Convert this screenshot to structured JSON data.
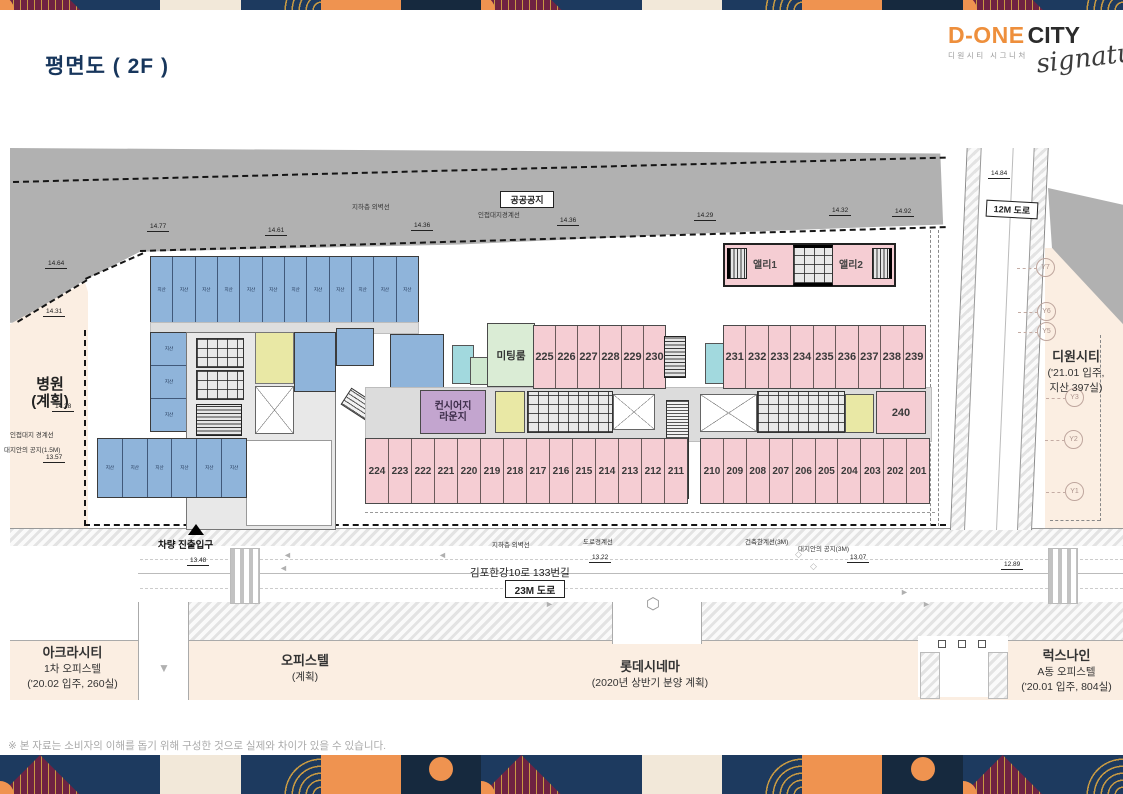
{
  "title": "평면도 ( 2F )",
  "logo": {
    "brand_orange": "D-ONE",
    "brand_dark": "CITY",
    "brand_sub": "디원시티 시그니처",
    "script": "signature"
  },
  "footnote": "※ 본 자료는 소비자의 이해를 돕기 위해 구성한 것으로 실제와 차이가 있을 수 있습니다.",
  "plan": {
    "labels": {
      "public_space": "공공공지",
      "underground_wall": "지하층 외벽선",
      "adjacent_boundary": "인접대지경계선",
      "road_12m": "12M 도로",
      "hospital": "병원",
      "hospital_sub": "(계획)",
      "adjacent_boundary_left": "인접대지 경계선",
      "site_setback_left": "대지안의 공지(1.5M)",
      "vehicle_entrance": "차량 진출입구",
      "underground_wall_bottom": "지하층 외벽선",
      "road_boundary": "도로경계선",
      "building_limit": "건축한계선(3M)",
      "site_setback_right": "대지안의 공지(3M)",
      "road_name": "김포한강10로 133번길",
      "road_23m": "23M 도로"
    },
    "dims": [
      "14.77",
      "14.61",
      "14.36",
      "14.36",
      "14.29",
      "14.32",
      "14.92",
      "14.84",
      "14.64",
      "14.31",
      "14.28",
      "13.57",
      "13.48",
      "13.22",
      "13.07",
      "12.89"
    ],
    "grid_markers": [
      "Y7",
      "Y6",
      "Y5",
      "Y3",
      "Y2",
      "Y1"
    ],
    "rooms": {
      "meeting_room": "미팅룸",
      "lounge_line1": "컨시어지",
      "lounge_line2": "라운지",
      "alley1": "앨리1",
      "alley2": "앨리2",
      "room_240": "240",
      "blue_unit_label": "지산",
      "row_225_230": [
        "225",
        "226",
        "227",
        "228",
        "229",
        "230"
      ],
      "row_231_239": [
        "231",
        "232",
        "233",
        "234",
        "235",
        "236",
        "237",
        "238",
        "239"
      ],
      "row_224_211": [
        "224",
        "223",
        "222",
        "221",
        "220",
        "219",
        "218",
        "217",
        "216",
        "215",
        "214",
        "213",
        "212",
        "211"
      ],
      "row_210_201": [
        "210",
        "209",
        "208",
        "207",
        "206",
        "205",
        "204",
        "203",
        "202",
        "201"
      ]
    }
  },
  "neighbors": {
    "dione": {
      "name": "디원시티",
      "line2": "('21.01 입주,",
      "line3": "지산 397실)"
    },
    "acra": {
      "name": "아크라시티",
      "line2": "1차 오피스텔",
      "line3": "('20.02 입주, 260실)"
    },
    "officetel": {
      "name": "오피스텔",
      "line2": "(계획)"
    },
    "lotte": {
      "name": "롯데시네마",
      "line2": "(2020년 상반기 분양 계획)"
    },
    "luxnine": {
      "name": "럭스나인",
      "line2": "A동 오피스텔",
      "line3": "('20.01 입주, 804실)"
    }
  },
  "colors": {
    "title_navy": "#17365c",
    "brand_orange": "#ee8f3c",
    "room_pink": "#f5cdd3",
    "room_blue": "#8fb4da",
    "meeting_green": "#daecd5",
    "lounge_purple": "#c3a5cf",
    "core_yellow": "#e9e8a5",
    "cyan": "#a2d9de",
    "slope_gray": "#b1b1b1",
    "cream": "#fbeee2",
    "band_navy": "#1d3a5f",
    "band_maroon": "#6f2342",
    "band_gold": "#c89a43",
    "band_orange": "#ef9350",
    "band_dark": "#16293e",
    "band_cream": "#f2e8d9"
  },
  "decor": {
    "sequence": [
      "tri",
      "navy",
      "cream",
      "arc",
      "orange",
      "circle",
      "tri",
      "navy",
      "cream",
      "arc",
      "orange",
      "circle",
      "tri",
      "arc"
    ]
  }
}
